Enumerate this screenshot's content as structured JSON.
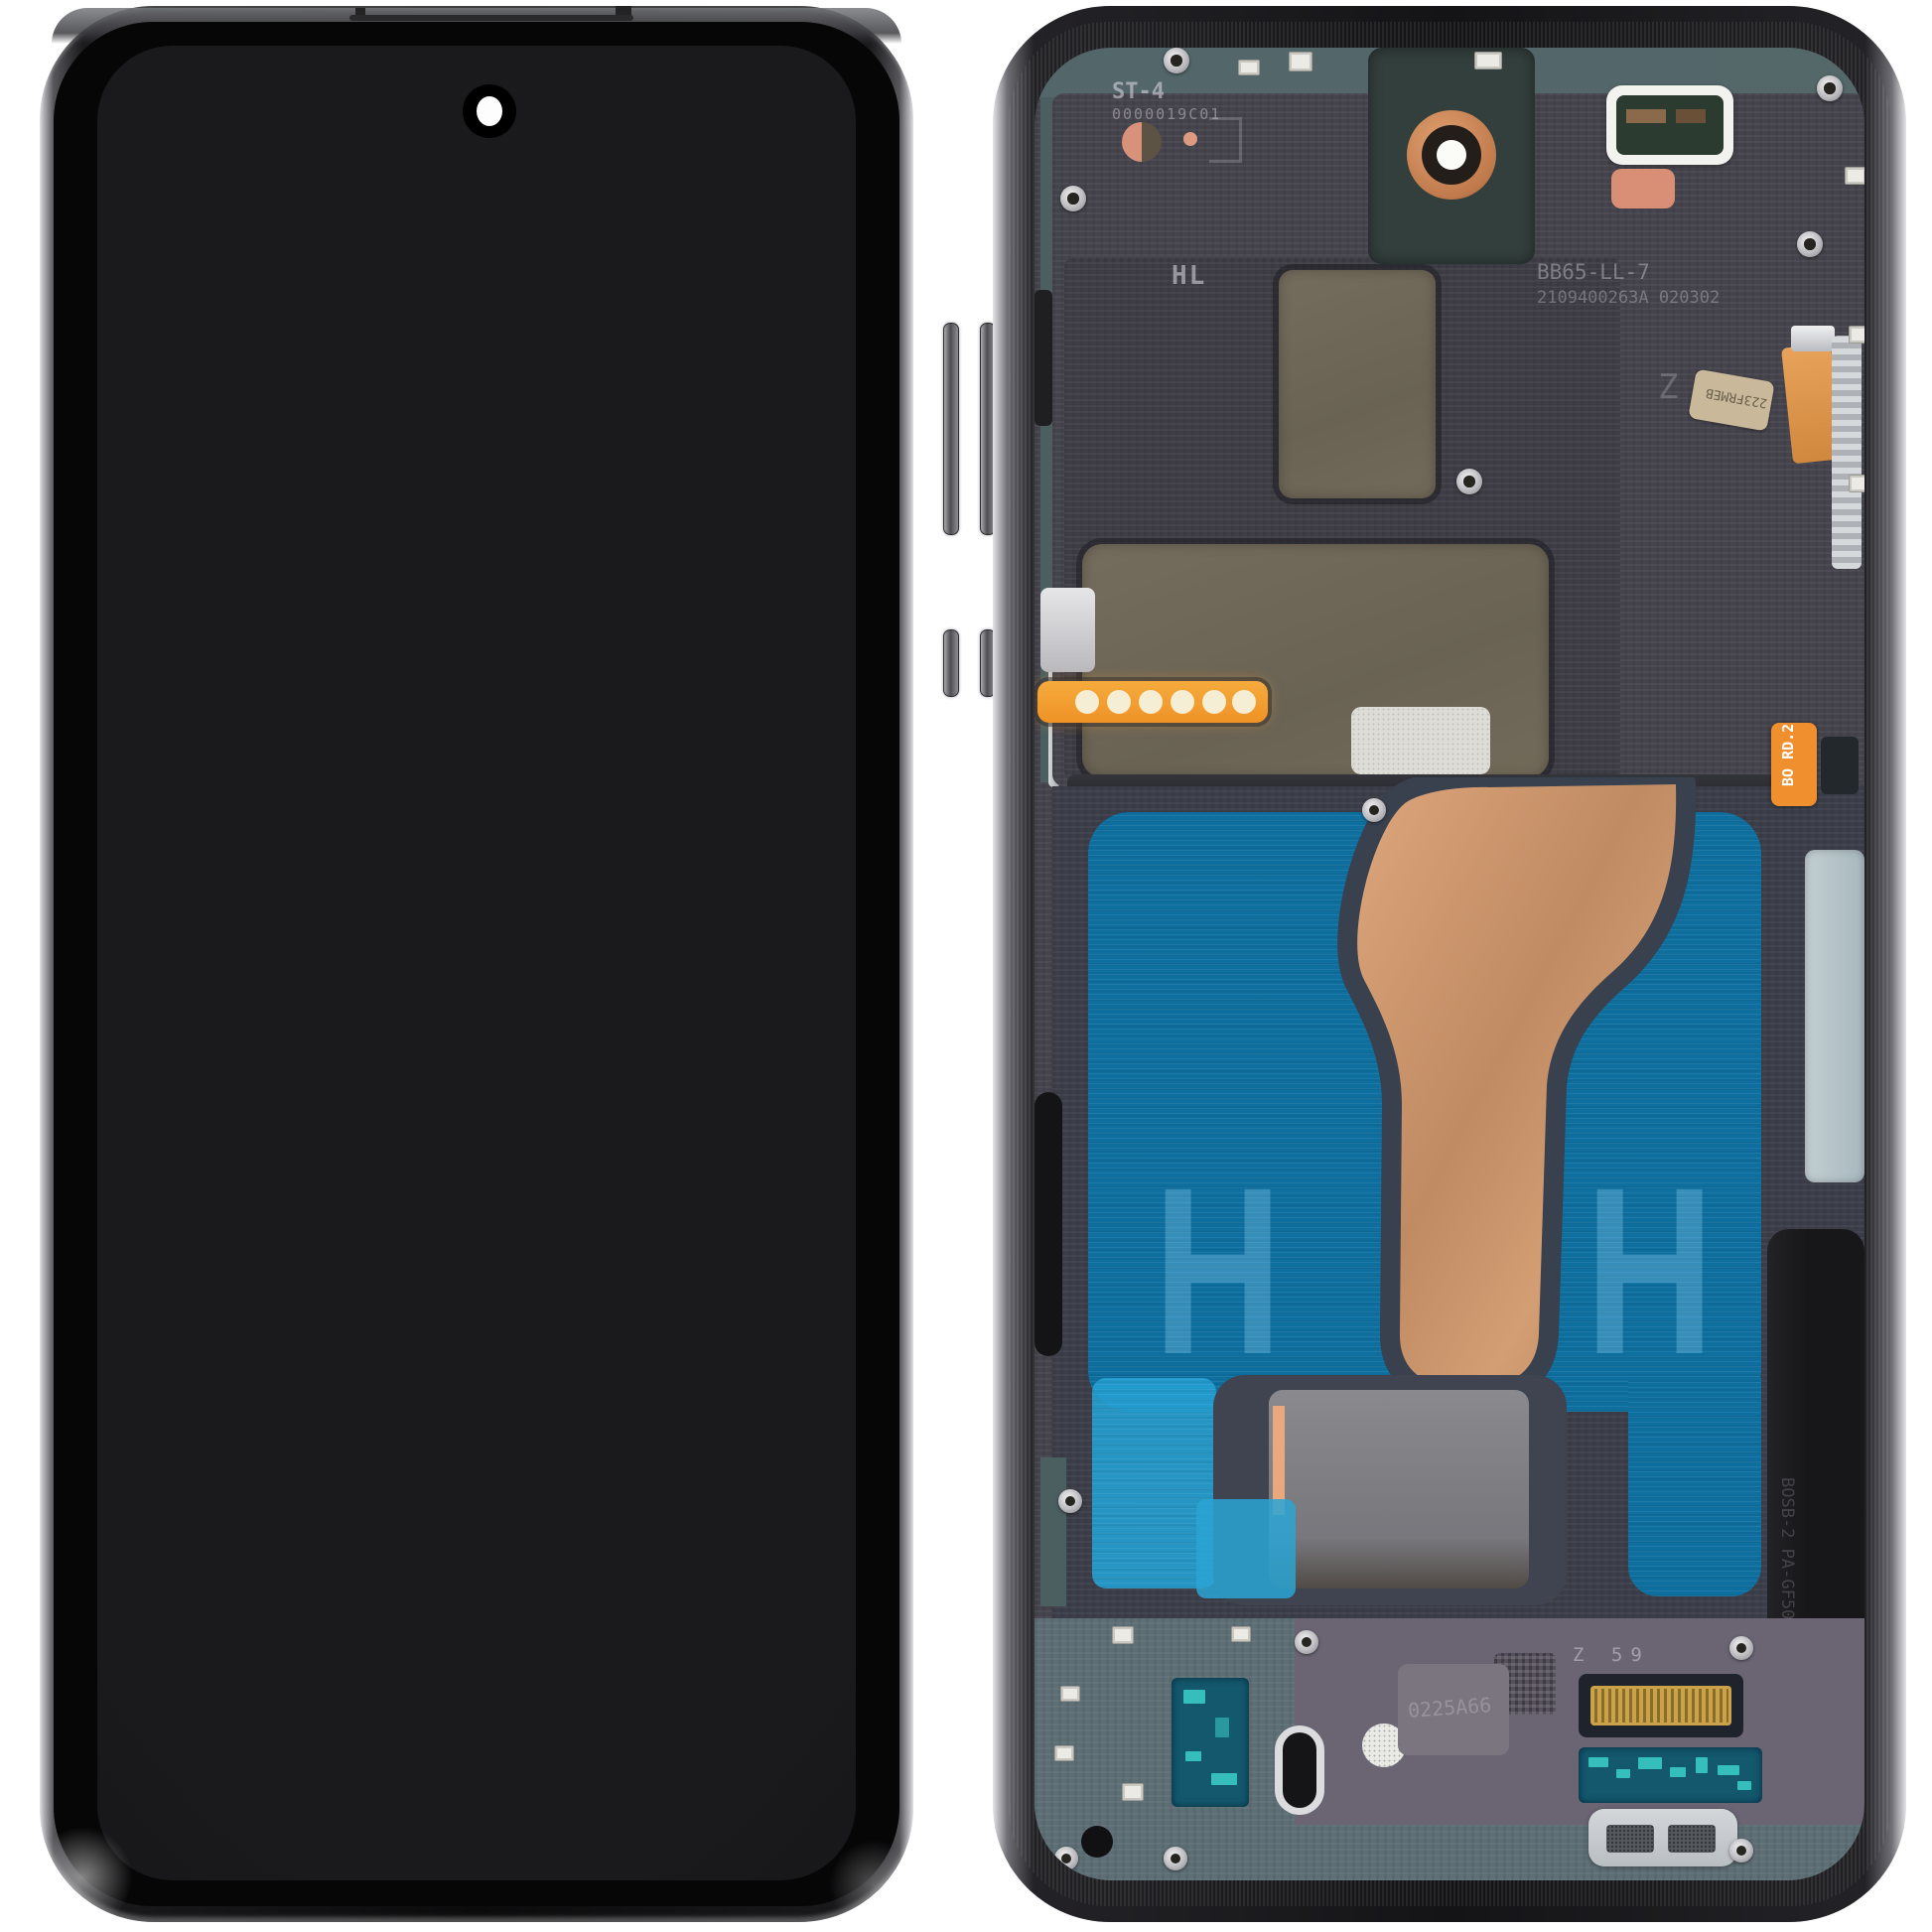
{
  "product": {
    "subject": "Smartphone display assembly, front and rear view",
    "background_color": "#ffffff"
  },
  "rear_markings": {
    "st4": "ST-4",
    "st4_code": "0000019C01",
    "hl": "HL",
    "mold_line1": "BB65-LL-7",
    "mold_line2": "2109400263A 020302",
    "z_stamp": "Z",
    "flex_sticker": "223FRMEB",
    "bo_sticker": "BO RD.2",
    "z59": "Z 59",
    "bottom_code": "0225A66",
    "side_strip_code": "BOSB-2 PA-GF50",
    "h_mark": "H"
  },
  "colors": {
    "copper_flex": "#c08a62",
    "adhesive_blue": "#0e6f9f",
    "adhesive_cyan_tab": "#249fd2",
    "antenna_flex_orange": "#f09a30",
    "sticker_orange": "#ef8f2e",
    "connector_gold": "#c9a24a",
    "midframe_lavender": "#a89eac",
    "graphite_sheet": "#45434b",
    "top_deck_teal": "#53666a",
    "screen_black": "#0b0b0c"
  }
}
